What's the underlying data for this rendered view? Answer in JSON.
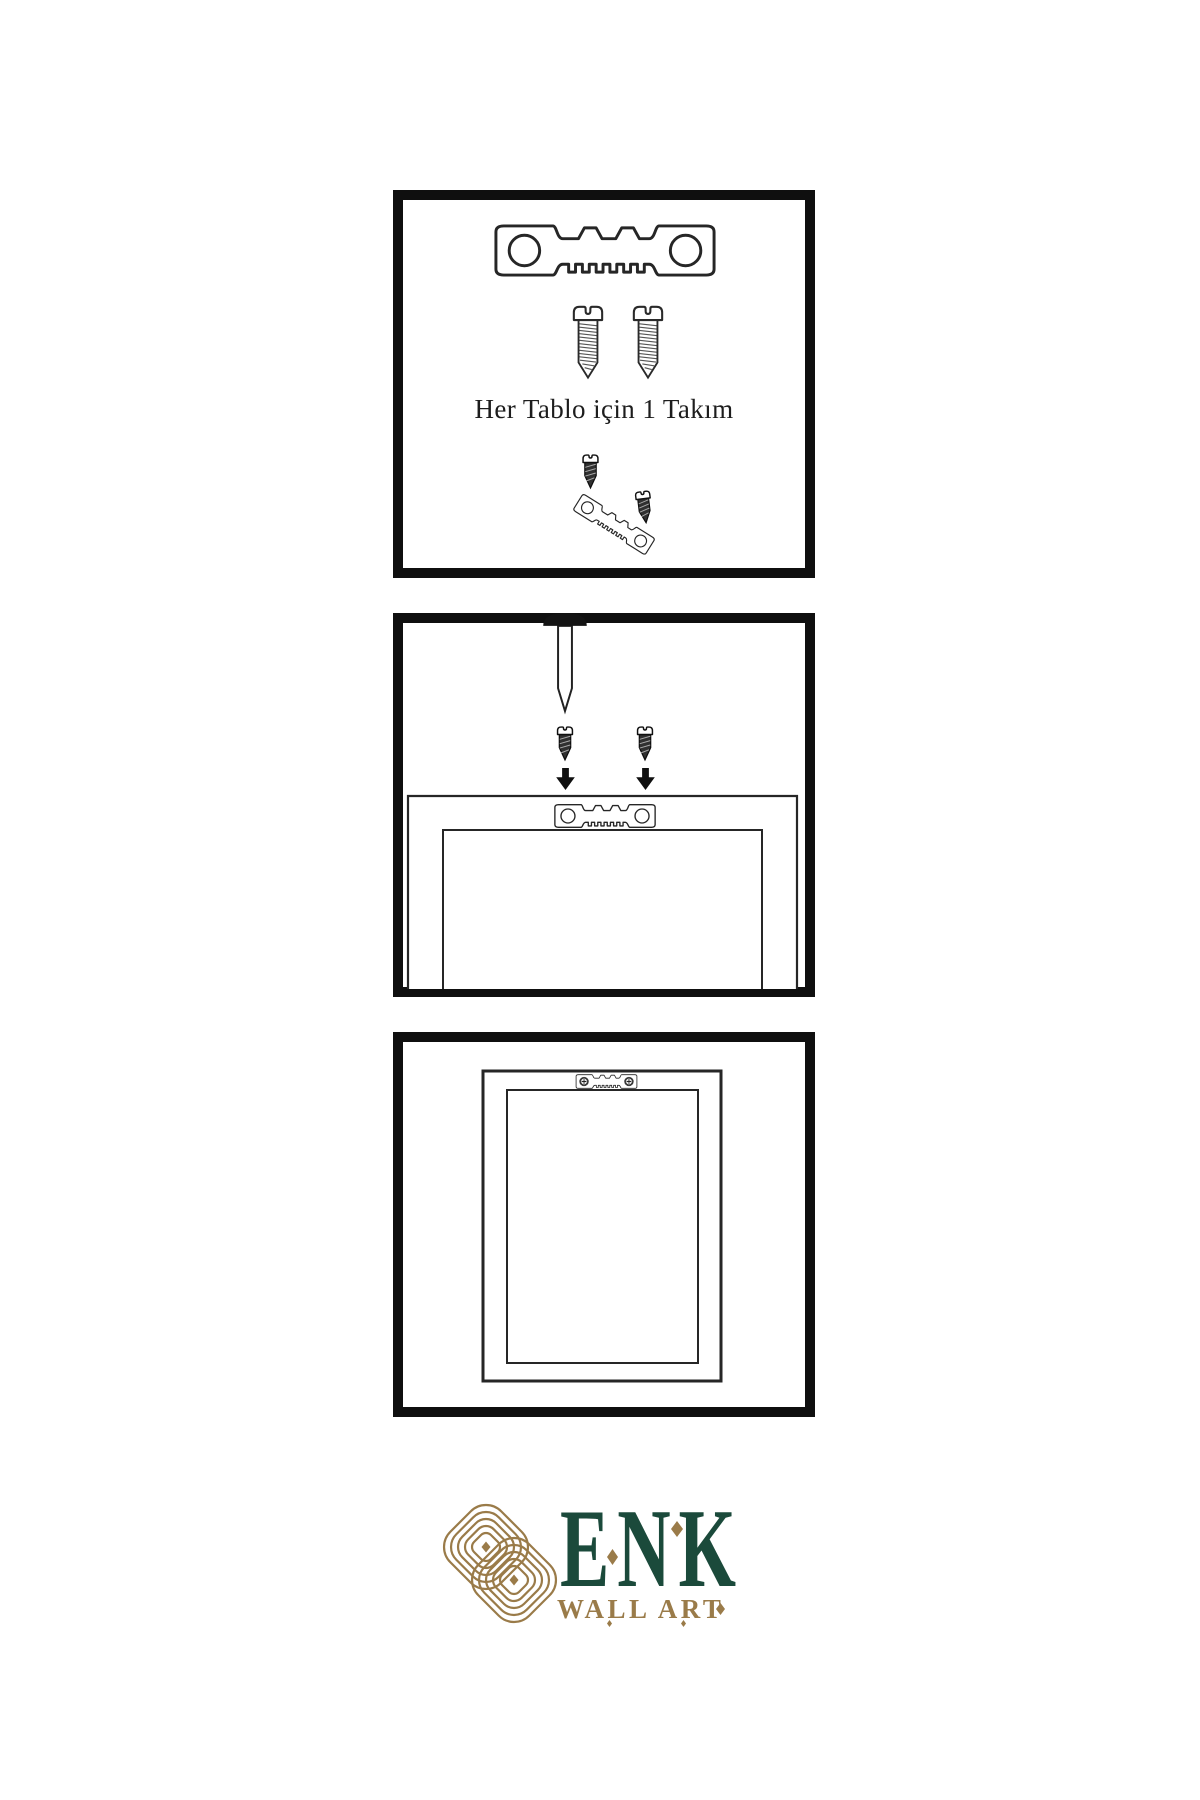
{
  "instructions": {
    "step1_caption": "Her Tablo için 1 Takım"
  },
  "logo": {
    "name": "ENK",
    "subtitle": "WALL ART",
    "green": "#1b4a3b",
    "gold": "#9a7b49"
  },
  "palette": {
    "background": "#ffffff",
    "panel_border": "#0f0f0f",
    "line": "#262626",
    "caption_text": "#1d1d1d"
  },
  "icons": {
    "step1": [
      "sawtooth-hanger-icon",
      "screw-icon",
      "screw-icon",
      "dark-screw-icon",
      "tilted-sawtooth-hanger-icon",
      "dark-screw-icon"
    ],
    "step2": [
      "wall-nail-icon",
      "dark-screw-icon",
      "dark-screw-icon",
      "down-arrow-icon",
      "down-arrow-icon",
      "frame-back-icon",
      "sawtooth-hanger-icon"
    ],
    "step3": [
      "hung-frame-icon",
      "mounted-sawtooth-hanger-icon"
    ],
    "footer": [
      "knot-logo-icon",
      "diamond-ornament"
    ]
  }
}
